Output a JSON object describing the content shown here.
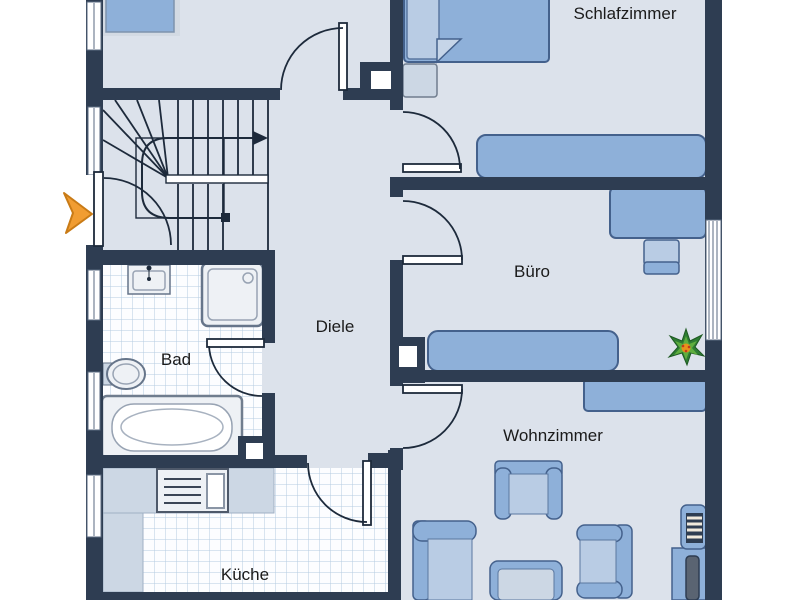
{
  "rooms": {
    "schlafzimmer": {
      "label": "Schlafzimmer"
    },
    "buero": {
      "label": "Büro"
    },
    "diele": {
      "label": "Diele"
    },
    "bad": {
      "label": "Bad"
    },
    "wohnzimmer": {
      "label": "Wohnzimmer"
    },
    "kueche": {
      "label": "Küche"
    }
  },
  "icons": {
    "entry_arrow": "orange right-pointing entrance marker",
    "plant": "green potted plant",
    "stairs": "U-shaped staircase with up-direction arrow"
  },
  "colors": {
    "wall": "#2e3d52",
    "floor": "#dce2eb",
    "outside": "#ffffff",
    "furniture": "#8eb0d9",
    "furniture_light": "#b9cce4",
    "furniture_pale": "#ccd7e4",
    "furniture_stroke": "#44618c",
    "tile_bg": "#fcfdff",
    "tile_line": "#b4cbe1",
    "fixture": "#eef1f5",
    "fixture_stroke": "#66758a",
    "line": "#1d2a3b",
    "text": "#1b1b1b",
    "entry_arrow": "#f19d32",
    "entry_arrow_stroke": "#c97b16",
    "plant_dark": "#2e7d33",
    "plant_light": "#5fae3e",
    "plant_center": "#e8921b",
    "window_frame": "#5a6a80"
  }
}
